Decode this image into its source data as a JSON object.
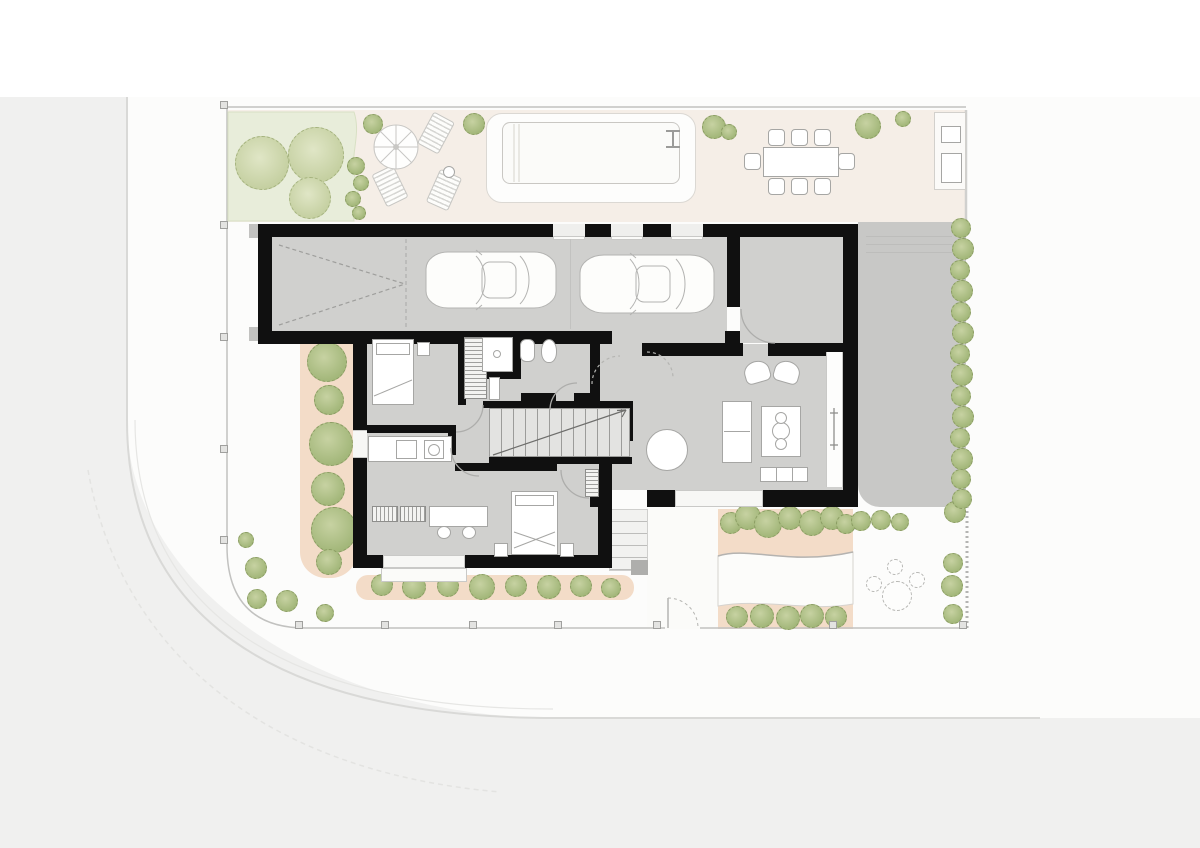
{
  "scene": {
    "kind": "architectural ground-floor site plan, top view, no text labels",
    "rooms": [
      "garage",
      "sitting-room",
      "hall",
      "bathroom",
      "wardrobe",
      "stair",
      "kitchen",
      "bedroom-1",
      "bedroom-2",
      "living-dining-room"
    ],
    "outdoor": [
      "street",
      "sidewalk",
      "fence",
      "lawn",
      "swimming-pool",
      "pool-deck",
      "parasol",
      "sun-loungers",
      "outdoor-dining-table",
      "outdoor-kitchen",
      "driveway",
      "hedge",
      "planting-beds",
      "entry-steps",
      "entry-gate",
      "garden-seating"
    ],
    "counts": {
      "cars_in_garage": 2,
      "outdoor_dining_chairs": 8,
      "sitting_room_chairs": 5,
      "living_dining_chairs": 4,
      "sun_loungers": 3,
      "garage_top_windows": 3,
      "lawn_trees": 3,
      "west_bed_trees": 6
    }
  },
  "palette": {
    "wall": "#101010",
    "floor": "#d0d0ce",
    "road": "#f0f0ef",
    "sidewalk": "#fcfcfb",
    "patio": "#f5eee7",
    "lawn": "#e8edda",
    "planting": "#f3dcc8",
    "driveway": "#c8c8c6",
    "foliage": "#a9ba82",
    "foliage_light": "#ccd6ab",
    "pool": "#fbfbf9",
    "outline": "#a6a6a4"
  },
  "figures": {
    "lawn_trees": [
      [
        262,
        163,
        27
      ],
      [
        316,
        155,
        28
      ],
      [
        310,
        198,
        21
      ]
    ],
    "lawn_bushes": [
      [
        356,
        166,
        9
      ],
      [
        361,
        183,
        8
      ],
      [
        353,
        199,
        8
      ],
      [
        359,
        213,
        7
      ],
      [
        373,
        124,
        10
      ],
      [
        474,
        124,
        11
      ]
    ],
    "patio_bushes": [
      [
        714,
        127,
        12
      ],
      [
        729,
        132,
        8
      ],
      [
        868,
        126,
        13
      ],
      [
        903,
        119,
        8
      ]
    ],
    "west_trees": [
      [
        327,
        362,
        20
      ],
      [
        329,
        400,
        15
      ],
      [
        331,
        444,
        22
      ],
      [
        328,
        489,
        17
      ],
      [
        334,
        530,
        23
      ],
      [
        329,
        562,
        13
      ]
    ],
    "south_bushes": [
      [
        382,
        585,
        11
      ],
      [
        414,
        587,
        12
      ],
      [
        448,
        586,
        11
      ],
      [
        482,
        587,
        13
      ],
      [
        516,
        586,
        11
      ],
      [
        549,
        587,
        12
      ],
      [
        581,
        586,
        11
      ],
      [
        611,
        588,
        10
      ]
    ],
    "sw_bushes": [
      [
        246,
        540,
        8
      ],
      [
        256,
        568,
        11
      ],
      [
        257,
        599,
        10
      ],
      [
        287,
        601,
        11
      ],
      [
        325,
        613,
        9
      ]
    ],
    "bed_top_bushes": [
      [
        731,
        523,
        11
      ],
      [
        748,
        517,
        13
      ],
      [
        768,
        524,
        14
      ],
      [
        790,
        518,
        12
      ],
      [
        812,
        523,
        13
      ],
      [
        832,
        518,
        12
      ],
      [
        846,
        524,
        10
      ]
    ],
    "bed_bottom_bushes": [
      [
        737,
        617,
        11
      ],
      [
        762,
        616,
        12
      ],
      [
        788,
        618,
        12
      ],
      [
        812,
        616,
        12
      ],
      [
        836,
        617,
        11
      ]
    ],
    "garden_bushes": [
      [
        861,
        521,
        10
      ],
      [
        881,
        520,
        10
      ],
      [
        900,
        522,
        9
      ],
      [
        955,
        512,
        11
      ],
      [
        953,
        563,
        10
      ],
      [
        952,
        586,
        11
      ],
      [
        953,
        614,
        10
      ]
    ],
    "hedge": [
      [
        961,
        228,
        10
      ],
      [
        963,
        249,
        11
      ],
      [
        960,
        270,
        10
      ],
      [
        962,
        291,
        11
      ],
      [
        961,
        312,
        10
      ],
      [
        963,
        333,
        11
      ],
      [
        960,
        354,
        10
      ],
      [
        962,
        375,
        11
      ],
      [
        961,
        396,
        10
      ],
      [
        963,
        417,
        11
      ],
      [
        960,
        438,
        10
      ],
      [
        962,
        459,
        11
      ],
      [
        961,
        479,
        10
      ],
      [
        962,
        499,
        10
      ]
    ],
    "fence_posts": [
      [
        224,
        105
      ],
      [
        224,
        225
      ],
      [
        224,
        337
      ],
      [
        224,
        449
      ],
      [
        224,
        540
      ],
      [
        299,
        625
      ],
      [
        385,
        625
      ],
      [
        473,
        625
      ],
      [
        558,
        625
      ],
      [
        657,
        625
      ],
      [
        833,
        625
      ],
      [
        963,
        625
      ]
    ],
    "driveway_lines": [
      236,
      244,
      252
    ],
    "dining_chairs": {
      "size": 17,
      "items": [
        [
          776,
          137
        ],
        [
          799,
          137
        ],
        [
          822,
          137
        ],
        [
          776,
          186
        ],
        [
          799,
          186
        ],
        [
          822,
          186
        ],
        [
          752,
          161
        ],
        [
          846,
          161
        ]
      ]
    },
    "sitting_chairs": {
      "size": 16,
      "items": [
        [
          770,
          254
        ],
        [
          771,
          283
        ],
        [
          772,
          312
        ],
        [
          808,
          267
        ],
        [
          810,
          297
        ]
      ]
    },
    "living_chairs": {
      "size": 15,
      "items": [
        [
          667,
          421
        ],
        [
          667,
          479
        ],
        [
          638,
          450
        ],
        [
          696,
          450
        ]
      ]
    },
    "garden_seating": {
      "table": [
        897,
        596,
        15
      ],
      "chairs": [
        [
          874,
          584,
          8
        ],
        [
          895,
          567,
          8
        ],
        [
          917,
          580,
          8
        ]
      ]
    }
  }
}
